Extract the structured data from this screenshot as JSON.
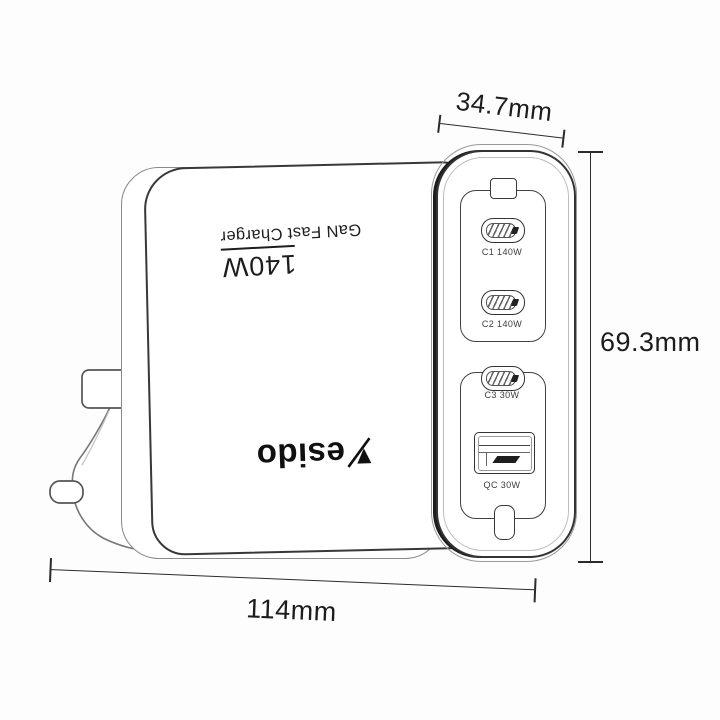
{
  "annotations": {
    "top_width": "34.7mm",
    "height": "69.3mm",
    "bottom_width": "114mm"
  },
  "charger": {
    "brand": "Yesido",
    "brand_display_after_mark": "esido",
    "print": {
      "wattage": "140W",
      "product_name": "GaN Fast Charger"
    },
    "ports": [
      {
        "type": "usb-c",
        "label": "C1 140W"
      },
      {
        "type": "usb-c",
        "label": "C2 140W"
      },
      {
        "type": "usb-c",
        "label": "C3 30W"
      },
      {
        "type": "usb-a",
        "label": "QC 30W"
      }
    ],
    "plug_type": "uk-plug"
  },
  "colors": {
    "dimension_line": "#2b2b2b",
    "outline": "#383838",
    "ink": "#101010",
    "background": "#fdfdfd"
  }
}
